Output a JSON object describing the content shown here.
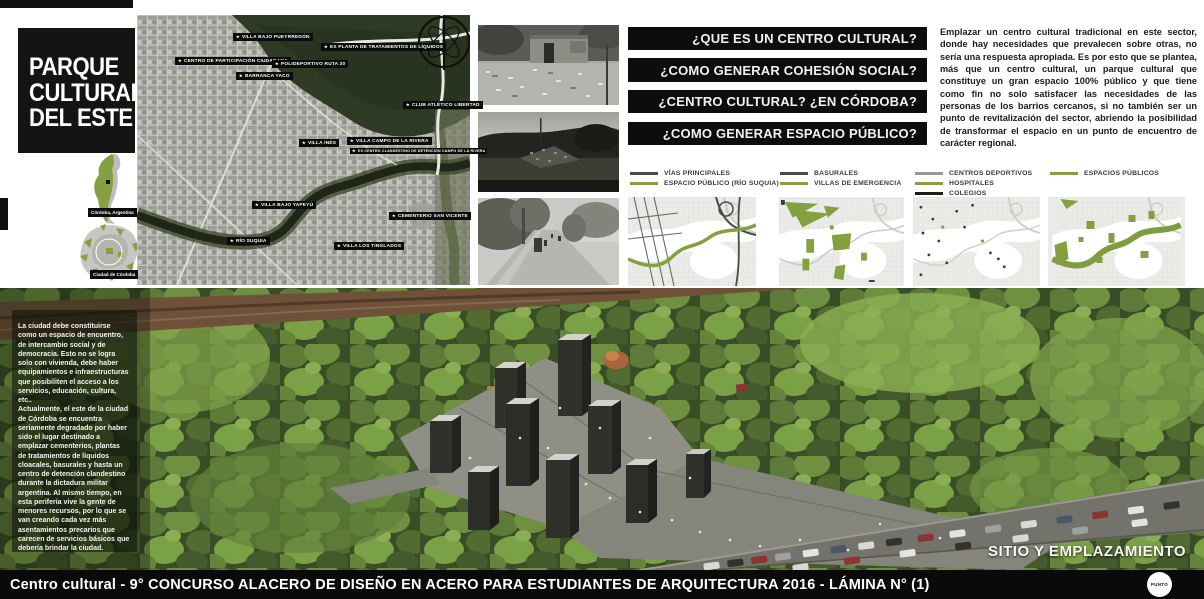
{
  "board": {
    "title_lines": [
      "PARQUE",
      "CULTURAL",
      "DEL ESTE"
    ],
    "locator": {
      "country_label": "Córdoba, Argentina",
      "city_label": "Ciudad de Córdoba"
    },
    "site_map": {
      "marker_icon": "★",
      "labels": [
        {
          "text": "VILLA BAJO PUEYRREDÓN"
        },
        {
          "text": "EX PLANTA DE TRATAMIENTOS DE LÍQUIDOS"
        },
        {
          "text": "CENTRO DE PARTICIPACIÓN CIUDADANA"
        },
        {
          "text": "POLIDEPORTIVO RUTA 20"
        },
        {
          "text": "BARRANCA YACO"
        },
        {
          "text": "CLUB ATLÉTICO LIBERTAD"
        },
        {
          "text": "VILLA INÉS"
        },
        {
          "text": "VILLA CAMPO DE LA RIVERA"
        },
        {
          "text": "EX CENTRO CLANDESTINO DE DETENCIÓN CAMPO DE LA RIVERA"
        },
        {
          "text": "VILLA BAJO YAPEYÚ"
        },
        {
          "text": "CEMENTERIO SAN VICENTE"
        },
        {
          "text": "RÍO SUQUIA"
        },
        {
          "text": "VILLA LOS TINGLADOS"
        }
      ]
    },
    "questions": [
      {
        "text": "¿QUE ES UN CENTRO CULTURAL?"
      },
      {
        "text": "¿COMO GENERAR COHESIÓN SOCIAL?"
      },
      {
        "text": "¿CENTRO CULTURAL? ¿EN CÓRDOBA?"
      },
      {
        "text": "¿COMO GENERAR ESPACIO PÚBLICO?"
      }
    ],
    "intro_paragraph": "Emplazar un centro cultural tradicional en este sector, donde hay necesidades que prevalecen sobre otras, no sería una respuesta apropiada. Es por esto que se plantea, más que un centro cultural, un parque cultural que constituye un gran espacio 100% público y que tiene como fin no solo satisfacer las necesidades de las personas de los barrios cercanos, si no también ser un punto de revitalización del sector, abriendo la posibilidad de transformar el espacio en un punto de encuentro de carácter regional.",
    "legend_groups": [
      {
        "items": [
          {
            "label": "VÍAS PRINCIPALES",
            "color": "#4a4a4a"
          },
          {
            "label": "ESPACIO PÚBLICO (RÍO SUQUIA)",
            "color": "#84a03f"
          }
        ]
      },
      {
        "items": [
          {
            "label": "BASURALES",
            "color": "#4a4a4a"
          },
          {
            "label": "VILLAS DE EMERGENCIA",
            "color": "#84a03f"
          }
        ]
      },
      {
        "items": [
          {
            "label": "CENTROS DEPORTIVOS",
            "color": "#9a9a95"
          },
          {
            "label": "HOSPITALES",
            "color": "#84a03f"
          },
          {
            "label": "COLEGIOS",
            "color": "#1d1d1b"
          }
        ]
      },
      {
        "items": [
          {
            "label": "ESPACIOS PÚBLICOS",
            "color": "#84a03f"
          }
        ]
      }
    ],
    "context_paragraphs": {
      "p1": "La ciudad debe constituirse como un espacio de encuentro, de intercambio social y de democracia. Esto no se logra solo con vivienda, debe haber equipamientos e infraestructuras que posibiliten el acceso a los servicios, educación, cultura, etc..",
      "p2": "Actualmente, el este de la ciudad de Córdoba se encuentra seriamente degradado por haber sido el lugar destinado a emplazar cementerios, plantas de tratamientos de líquidos cloacales, basurales y hasta un centro de detención clandestino durante la dictadura militar argentina. Al mismo tiempo, en esta periferia vive la gente de menores recursos, por lo que se van creando cada vez más asentamientos precarios que carecen de servicios básicos que debería brindar la ciudad."
    },
    "render_caption": "SITIO Y EMPLAZAMIENTO",
    "footer": {
      "text": "Centro cultural - 9° CONCURSO ALACERO DE DISEÑO EN ACERO PARA ESTUDIANTES DE ARQUITECTURA 2016 - LÁMINA N° (1)",
      "logo_text": "PUNTO"
    },
    "colors": {
      "accent_green": "#84a03f",
      "banner_bg": "#0d0d0d"
    }
  }
}
